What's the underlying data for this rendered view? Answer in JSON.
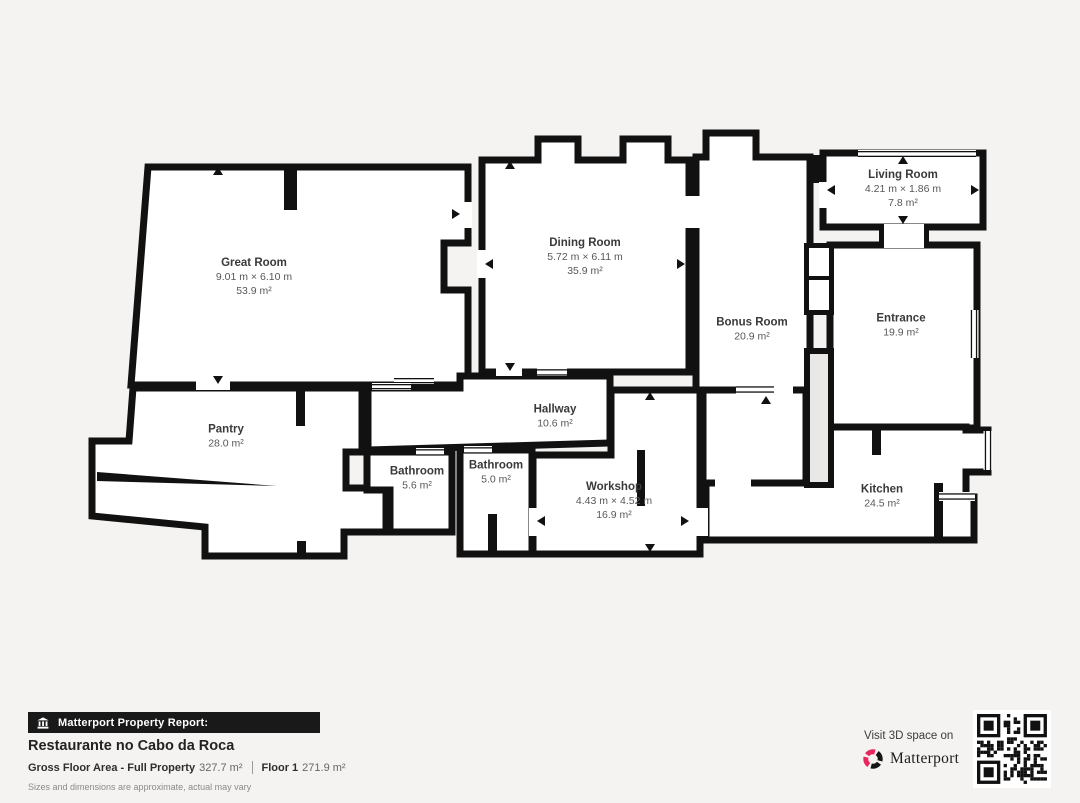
{
  "page": {
    "background": "#f4f3f1",
    "wall_color": "#111111"
  },
  "floorplan": {
    "rooms": [
      {
        "name": "Great Room",
        "dimensions": "9.01 m × 6.10 m",
        "area": "53.9 m²"
      },
      {
        "name": "Dining Room",
        "dimensions": "5.72 m × 6.11 m",
        "area": "35.9 m²"
      },
      {
        "name": "Living Room",
        "dimensions": "4.21 m × 1.86 m",
        "area": "7.8 m²"
      },
      {
        "name": "Bonus Room",
        "area": "20.9 m²"
      },
      {
        "name": "Entrance",
        "area": "19.9 m²"
      },
      {
        "name": "Pantry",
        "area": "28.0 m²"
      },
      {
        "name": "Hallway",
        "area": "10.6 m²"
      },
      {
        "name": "Bathroom",
        "area": "5.6 m²"
      },
      {
        "name": "Bathroom",
        "area": "5.0 m²"
      },
      {
        "name": "Workshop",
        "dimensions": "4.43 m × 4.52 m",
        "area": "16.9 m²"
      },
      {
        "name": "Kitchen",
        "area": "24.5 m²"
      }
    ]
  },
  "footer": {
    "badge": {
      "label": "Matterport Property Report:",
      "icon": "building-icon"
    },
    "property_title": "Restaurante no Cabo da Roca",
    "stats": {
      "gross_label": "Gross Floor Area - Full Property",
      "gross_value": "327.7 m²",
      "floor_label": "Floor 1",
      "floor_value": "271.9 m²"
    },
    "disclaimer": "Sizes and dimensions are approximate, actual may vary",
    "cta": {
      "text": "Visit 3D space on",
      "brand": "Matterport",
      "brand_color": "#e8265d"
    },
    "qr": {
      "label": "qr-code"
    }
  }
}
